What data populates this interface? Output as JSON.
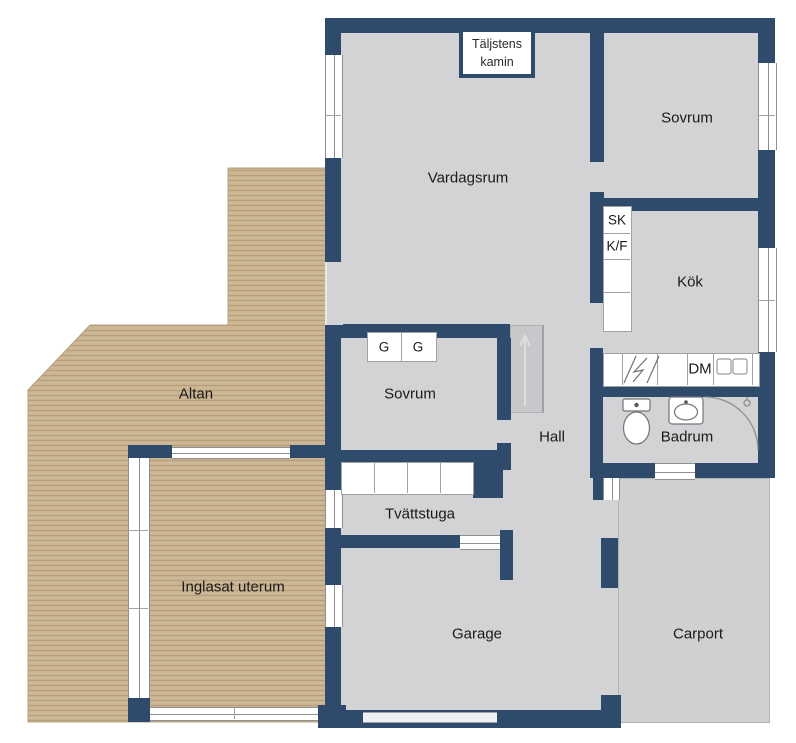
{
  "colors": {
    "wall": "#2e4b6b",
    "floor": "#d3d3d5",
    "floor_dark": "#c7c8ca",
    "carport": "#cfd0d2",
    "wood": "#c8b28f",
    "wood_dark": "#a98f6c",
    "wood_light": "#d6c3a3",
    "line": "#8f8f92",
    "text": "#1a1a1a"
  },
  "rooms": {
    "vardagsrum": "Vardagsrum",
    "sovrum_top": "Sovrum",
    "kok": "Kök",
    "sovrum_mid": "Sovrum",
    "hall": "Hall",
    "badrum": "Badrum",
    "tvattstuga": "Tvättstuga",
    "garage": "Garage",
    "carport": "Carport",
    "altan": "Altan",
    "uterum": "Inglasat uterum"
  },
  "fixtures": {
    "kamin": "Täljstens kamin",
    "sk": "SK",
    "kf": "K/F",
    "dm": "DM",
    "garderob": "G"
  }
}
